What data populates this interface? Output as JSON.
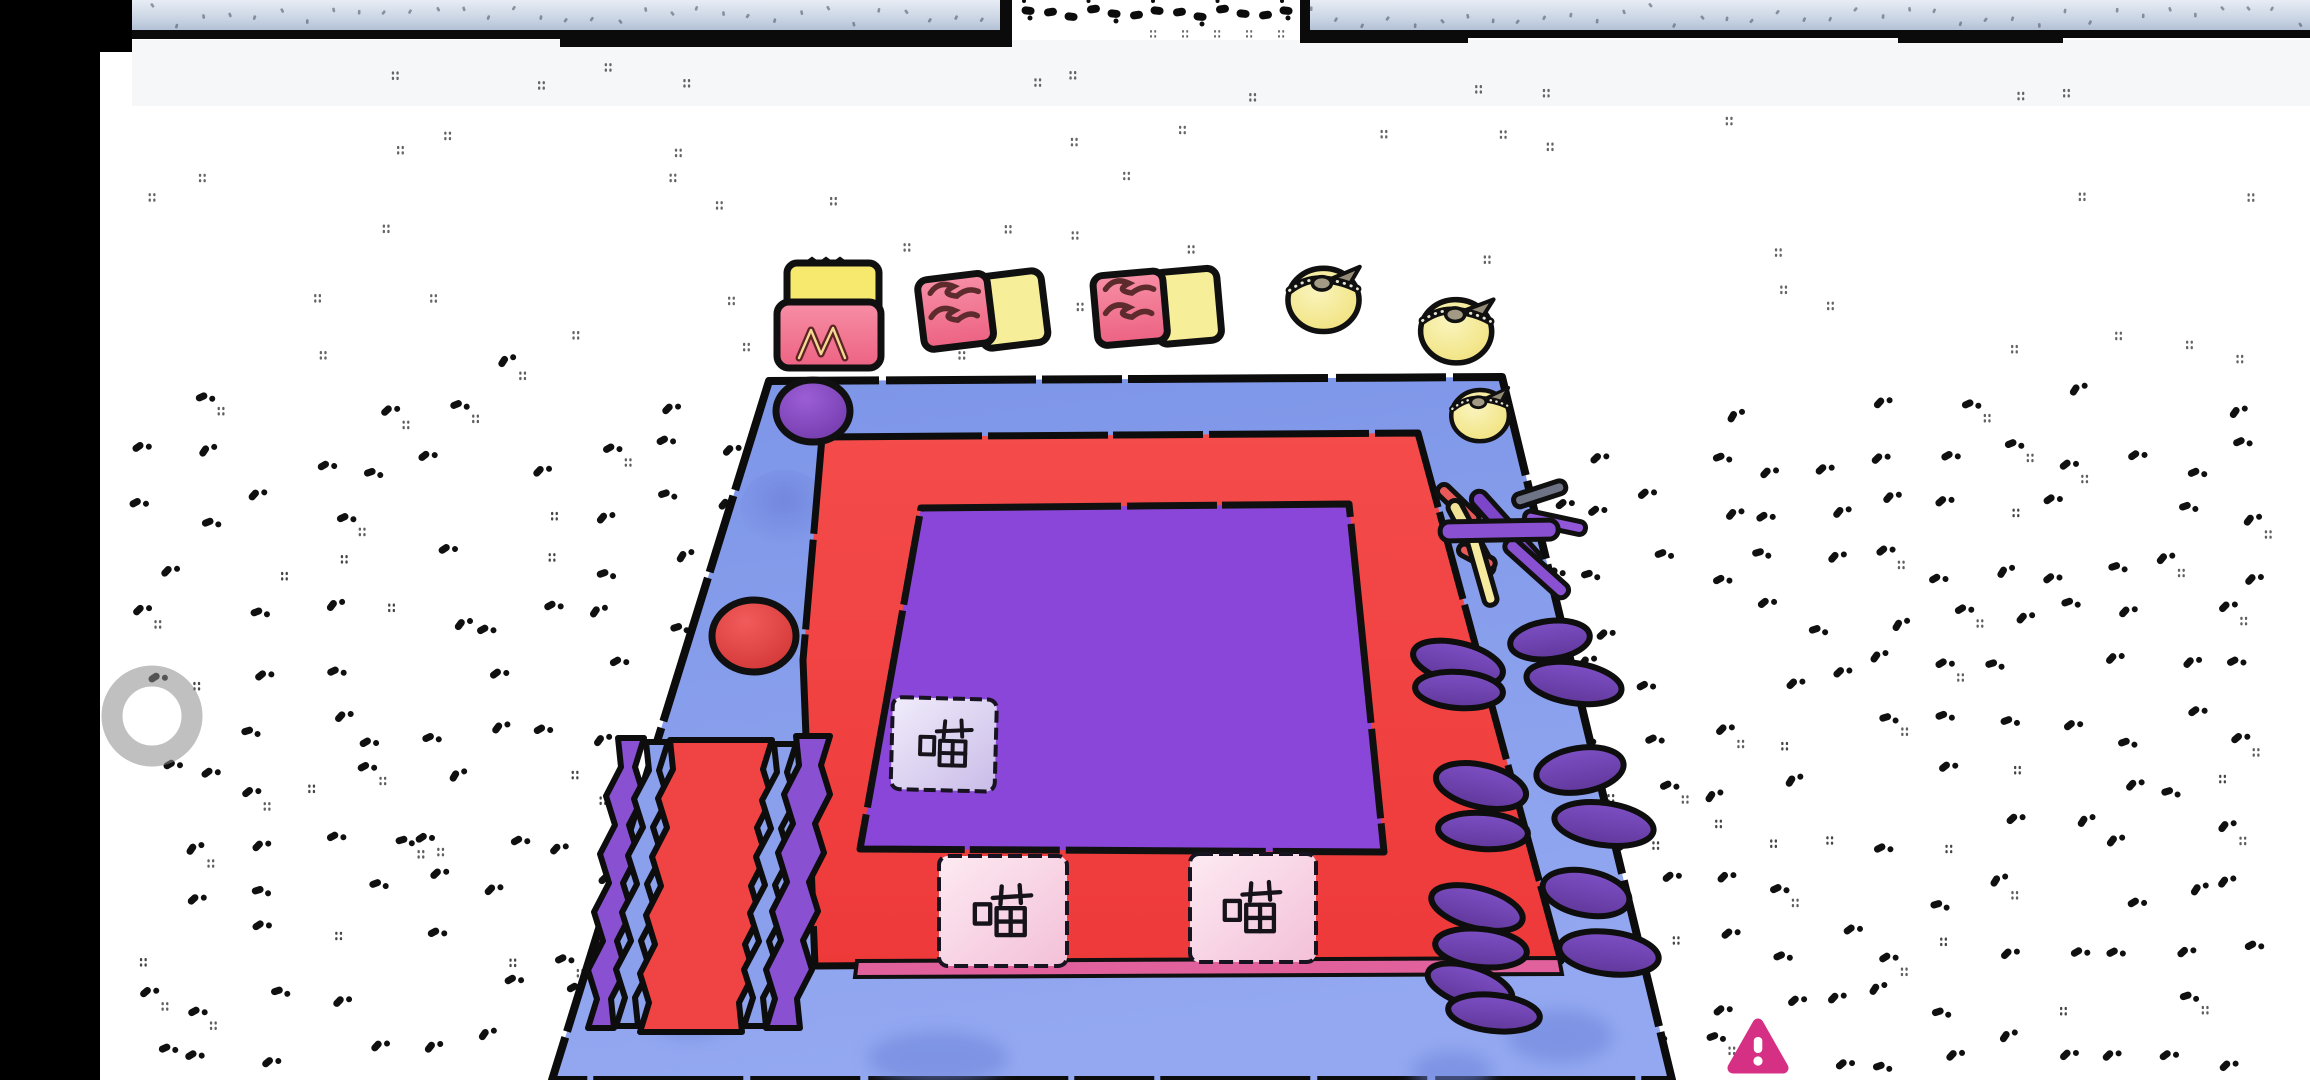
{
  "scene": {
    "description": "Cartoon 3D party-game arena seen from an elevated front view",
    "environment": {
      "floor_color": "#ffffff",
      "wall_color": "#c7d1e2",
      "wall_underline_color": "#0b0b0b",
      "letterbox_color": "#000000",
      "speckle_color": "#101010",
      "faint_speckle_color": "#555555"
    },
    "board": {
      "base_color": "#8098ea",
      "track_color": "#f24242",
      "track_edge_color": "#e0619c",
      "center_color": "#8a46d8",
      "outline_color": "#0d0d0d",
      "tiles": [
        {
          "label": "喵",
          "surface": "center-square",
          "tile_color": "#d9cdf2"
        },
        {
          "label": "喵",
          "surface": "track-bottom-left",
          "tile_color": "#f8cde0"
        },
        {
          "label": "喵",
          "surface": "track-bottom-right",
          "tile_color": "#fbdceb"
        }
      ],
      "props": {
        "petal_tokens": {
          "count": 14,
          "color": "#7347b5"
        },
        "stick_pile": {
          "colors": [
            "#8a50d2",
            "#f0e296",
            "#e85a5a",
            "#6f7386"
          ]
        },
        "domes": [
          {
            "name": "purple-dome",
            "color": "#8040b8"
          },
          {
            "name": "red-dome",
            "color": "#e04040"
          },
          {
            "name": "blue-bump",
            "color": "#8ea6f2"
          }
        ],
        "striped_ramp": {
          "stripe_colors": [
            "#8a50d2",
            "#8aa0ec",
            "#f04343",
            "#8aa0ec",
            "#8a50d2"
          ]
        }
      }
    },
    "floating_items": [
      {
        "name": "wrapped-snack",
        "marking": "M",
        "colors": [
          "#f6e96e",
          "#f0748e"
        ]
      },
      {
        "name": "rolled-snack-left",
        "marking": "S",
        "colors": [
          "#f0748e",
          "#f7ee9a"
        ]
      },
      {
        "name": "rolled-snack-right",
        "marking": "S",
        "colors": [
          "#f0748e",
          "#f7ee9a"
        ]
      },
      {
        "name": "pouch-dumpling-left",
        "colors": [
          "#f6eb9e"
        ]
      },
      {
        "name": "pouch-dumpling-right",
        "colors": [
          "#f6eb9e"
        ]
      },
      {
        "name": "pouch-dumpling-corner",
        "colors": [
          "#f6eb9e"
        ]
      }
    ],
    "hud": {
      "joystick": {
        "type": "ring",
        "color": "#8c8c8c"
      },
      "warning_badge": {
        "symbol": "!",
        "color": "#d63084"
      }
    }
  }
}
